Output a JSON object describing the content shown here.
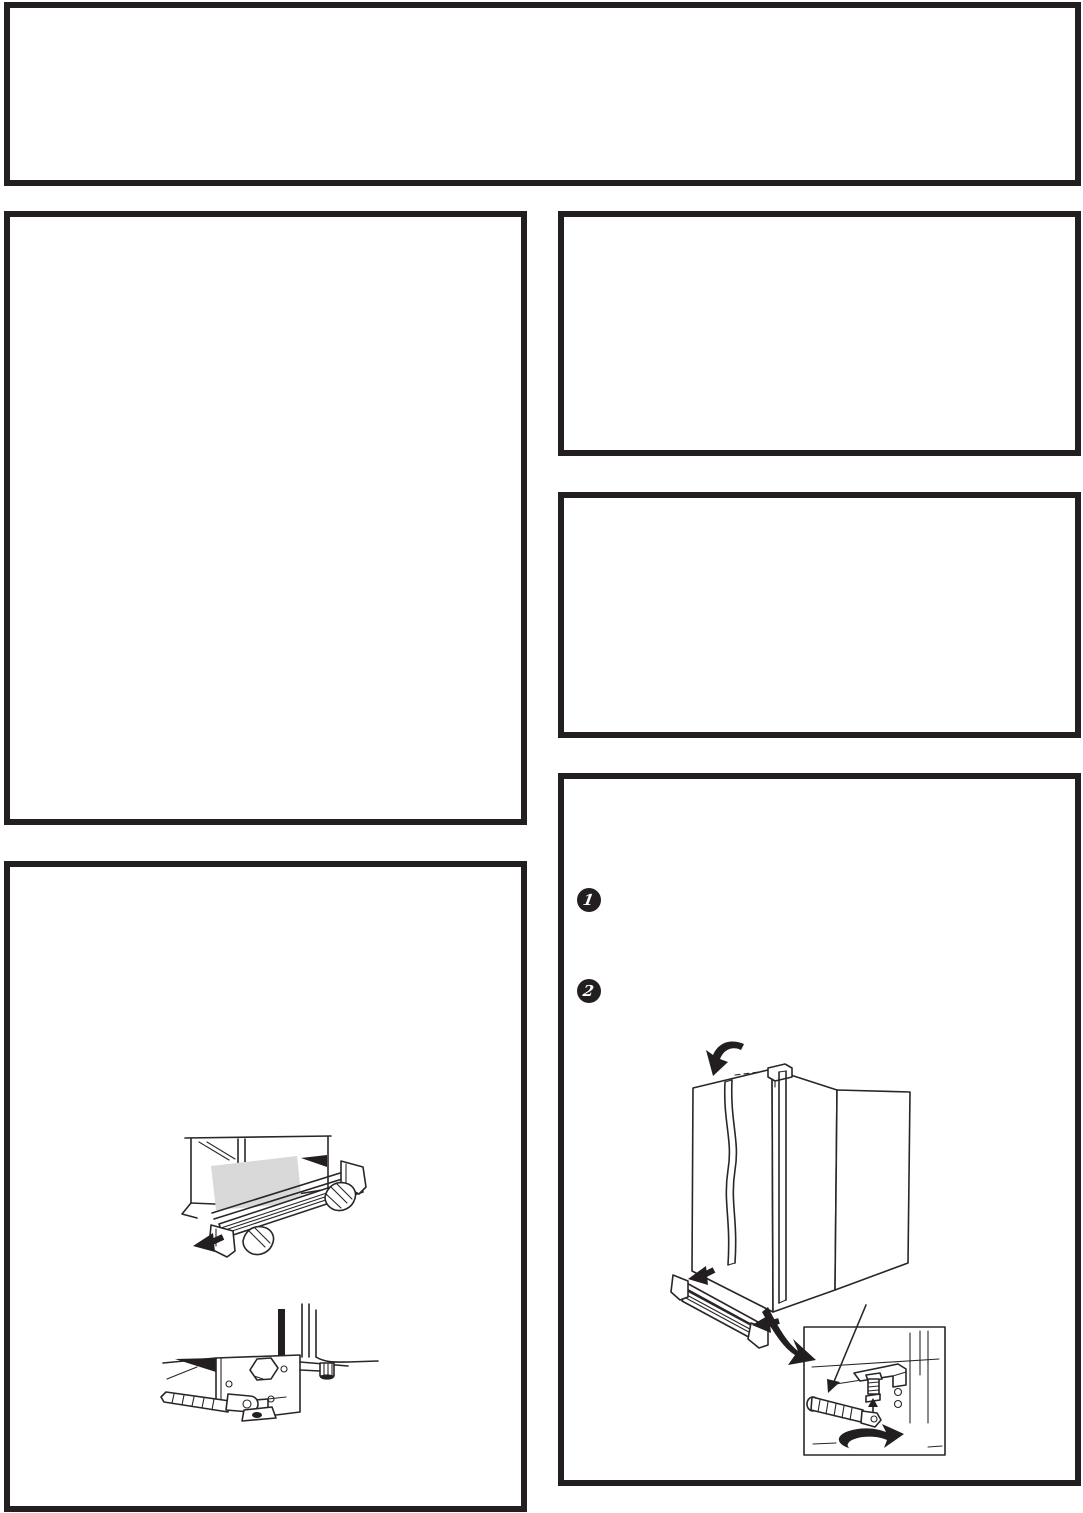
{
  "steps": [
    {
      "number": "1"
    },
    {
      "number": "2"
    }
  ],
  "colors": {
    "frame": "#231f20",
    "ink": "#2a2627",
    "paper": "#ffffff",
    "shade": "#d9d9d9"
  }
}
